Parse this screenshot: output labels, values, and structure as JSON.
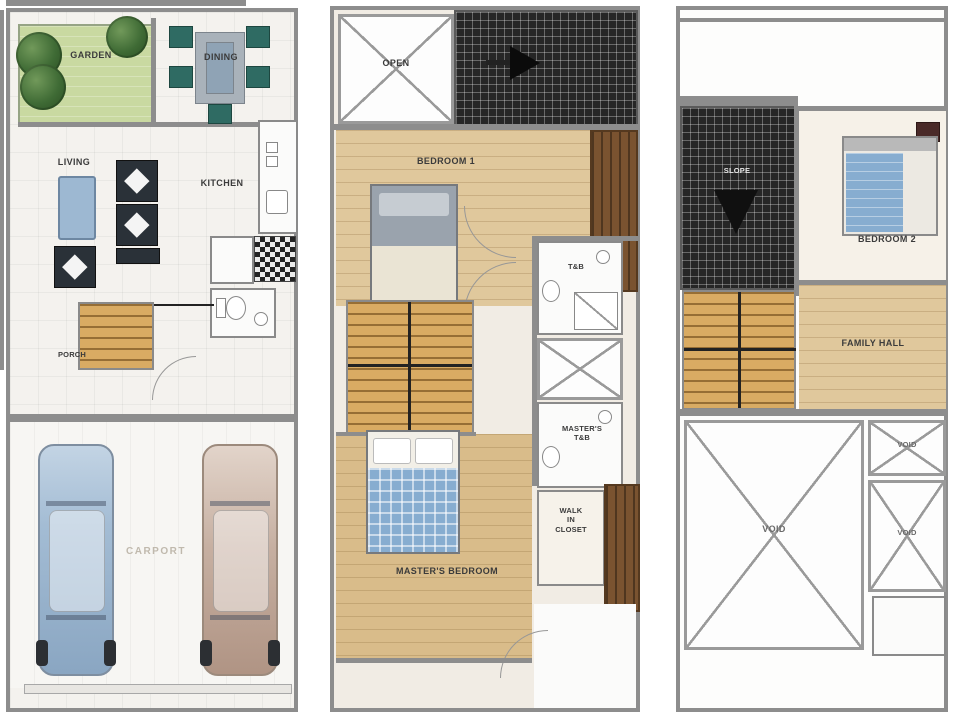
{
  "floors": {
    "ground": {
      "garden": "GARDEN",
      "dining": "DINING",
      "living": "LIVING",
      "kitchen": "KITCHEN",
      "porch": "PORCH",
      "carport": "CARPORT"
    },
    "second": {
      "open": "OPEN",
      "bedroom1": "BEDROOM 1",
      "tb": "T&B",
      "masters_tb": "MASTER'S\nT&B",
      "walk_in_closet": "WALK\nIN\nCLOSET",
      "masters_bedroom": "MASTER'S BEDROOM"
    },
    "third": {
      "slope": "SLOPE",
      "bedroom2": "BEDROOM 2",
      "family_hall": "FAMILY HALL",
      "void_main": "VOID",
      "void_small_top": "VOID",
      "void_small_mid": "VOID"
    }
  },
  "colors": {
    "wall": "#8d8d8d",
    "floor_light": "#f4f2ee",
    "wood_floor": "#e0c89c",
    "wood_floor_dark": "#d9bc8a",
    "stair_wood": "#d9ab63",
    "garden_green": "#c9d9a1",
    "tree_green": "#3f6b35",
    "dark_roof": "#262626",
    "plaid_blue": "#87add0",
    "sofa_blue": "#9db8d2",
    "chair_teal": "#2f6b63",
    "car_blue": "#a3bcd4",
    "car_tan": "#c6afa1",
    "closet_brown": "#7a5330",
    "label": "#3b3b3b",
    "label_light": "#c0b9ad"
  }
}
